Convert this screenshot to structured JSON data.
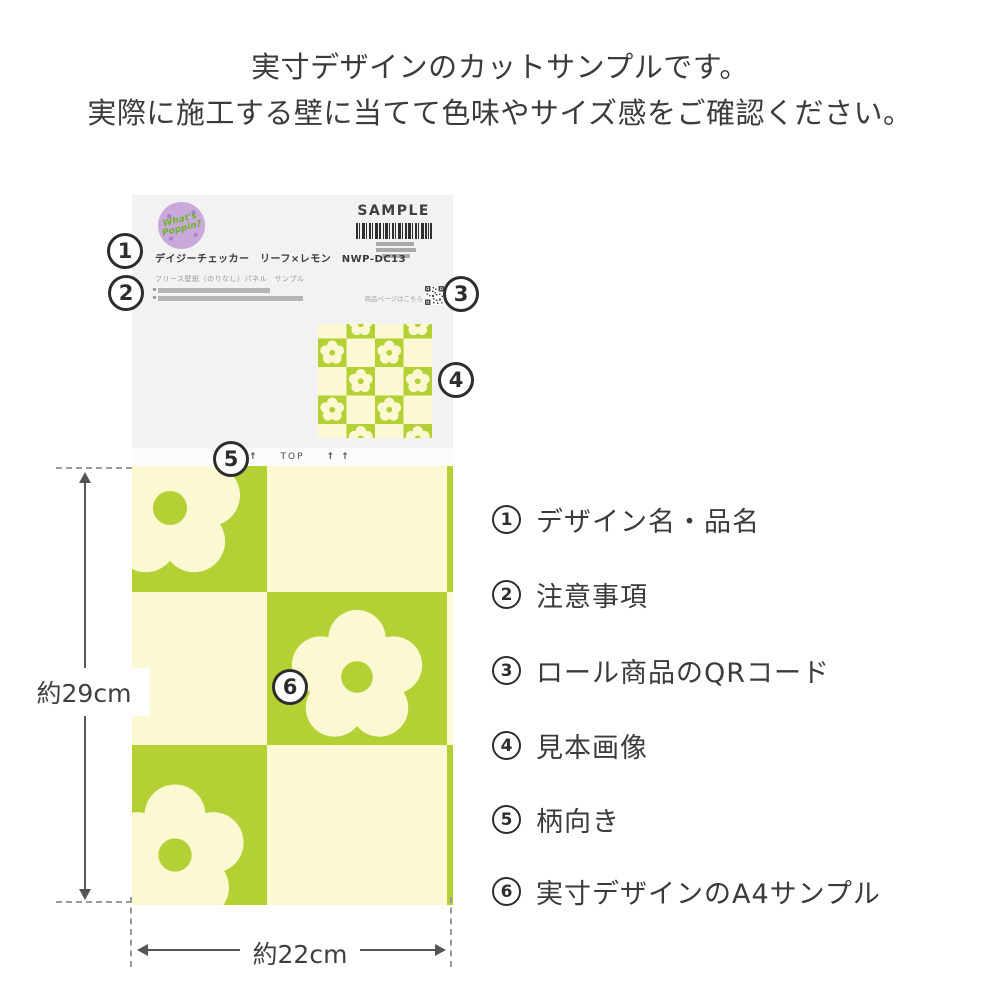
{
  "colors": {
    "green": "#b3d134",
    "cream": "#fbf8d2",
    "header_bg": "#f2f2f2",
    "text_dark": "#3b3b3b",
    "gray_bar": "#b5b5b5",
    "badge_purple": "#c9a9db",
    "badge_text": "#6fb42c",
    "line": "#555555"
  },
  "intro": {
    "line1": "実寸デザインのカットサンプルです。",
    "line2": "実際に施工する壁に当てて色味やサイズ感をご確認ください。"
  },
  "card": {
    "badge": {
      "line1": "What's",
      "line2": "Poppin?"
    },
    "sample_label": "SAMPLE",
    "title": "デイジーチェッカー　リーフ×レモン　NWP-DC13",
    "subtitle": "フリース壁紙（のりなし）パネル　サンプル",
    "qr_caption": "商品ページはこちら",
    "arrows": "↑ ↑",
    "top_label": "TOP"
  },
  "dimensions": {
    "height": "約29cm",
    "width": "約22cm"
  },
  "callouts": [
    "1",
    "2",
    "3",
    "4",
    "5",
    "6"
  ],
  "legend": [
    {
      "num": "1",
      "label": "デザイン名・品名"
    },
    {
      "num": "2",
      "label": "注意事項"
    },
    {
      "num": "3",
      "label": "ロール商品のQRコード"
    },
    {
      "num": "4",
      "label": "見本画像"
    },
    {
      "num": "5",
      "label": "柄向き"
    },
    {
      "num": "6",
      "label": "実寸デザインのA4サンプル"
    }
  ]
}
